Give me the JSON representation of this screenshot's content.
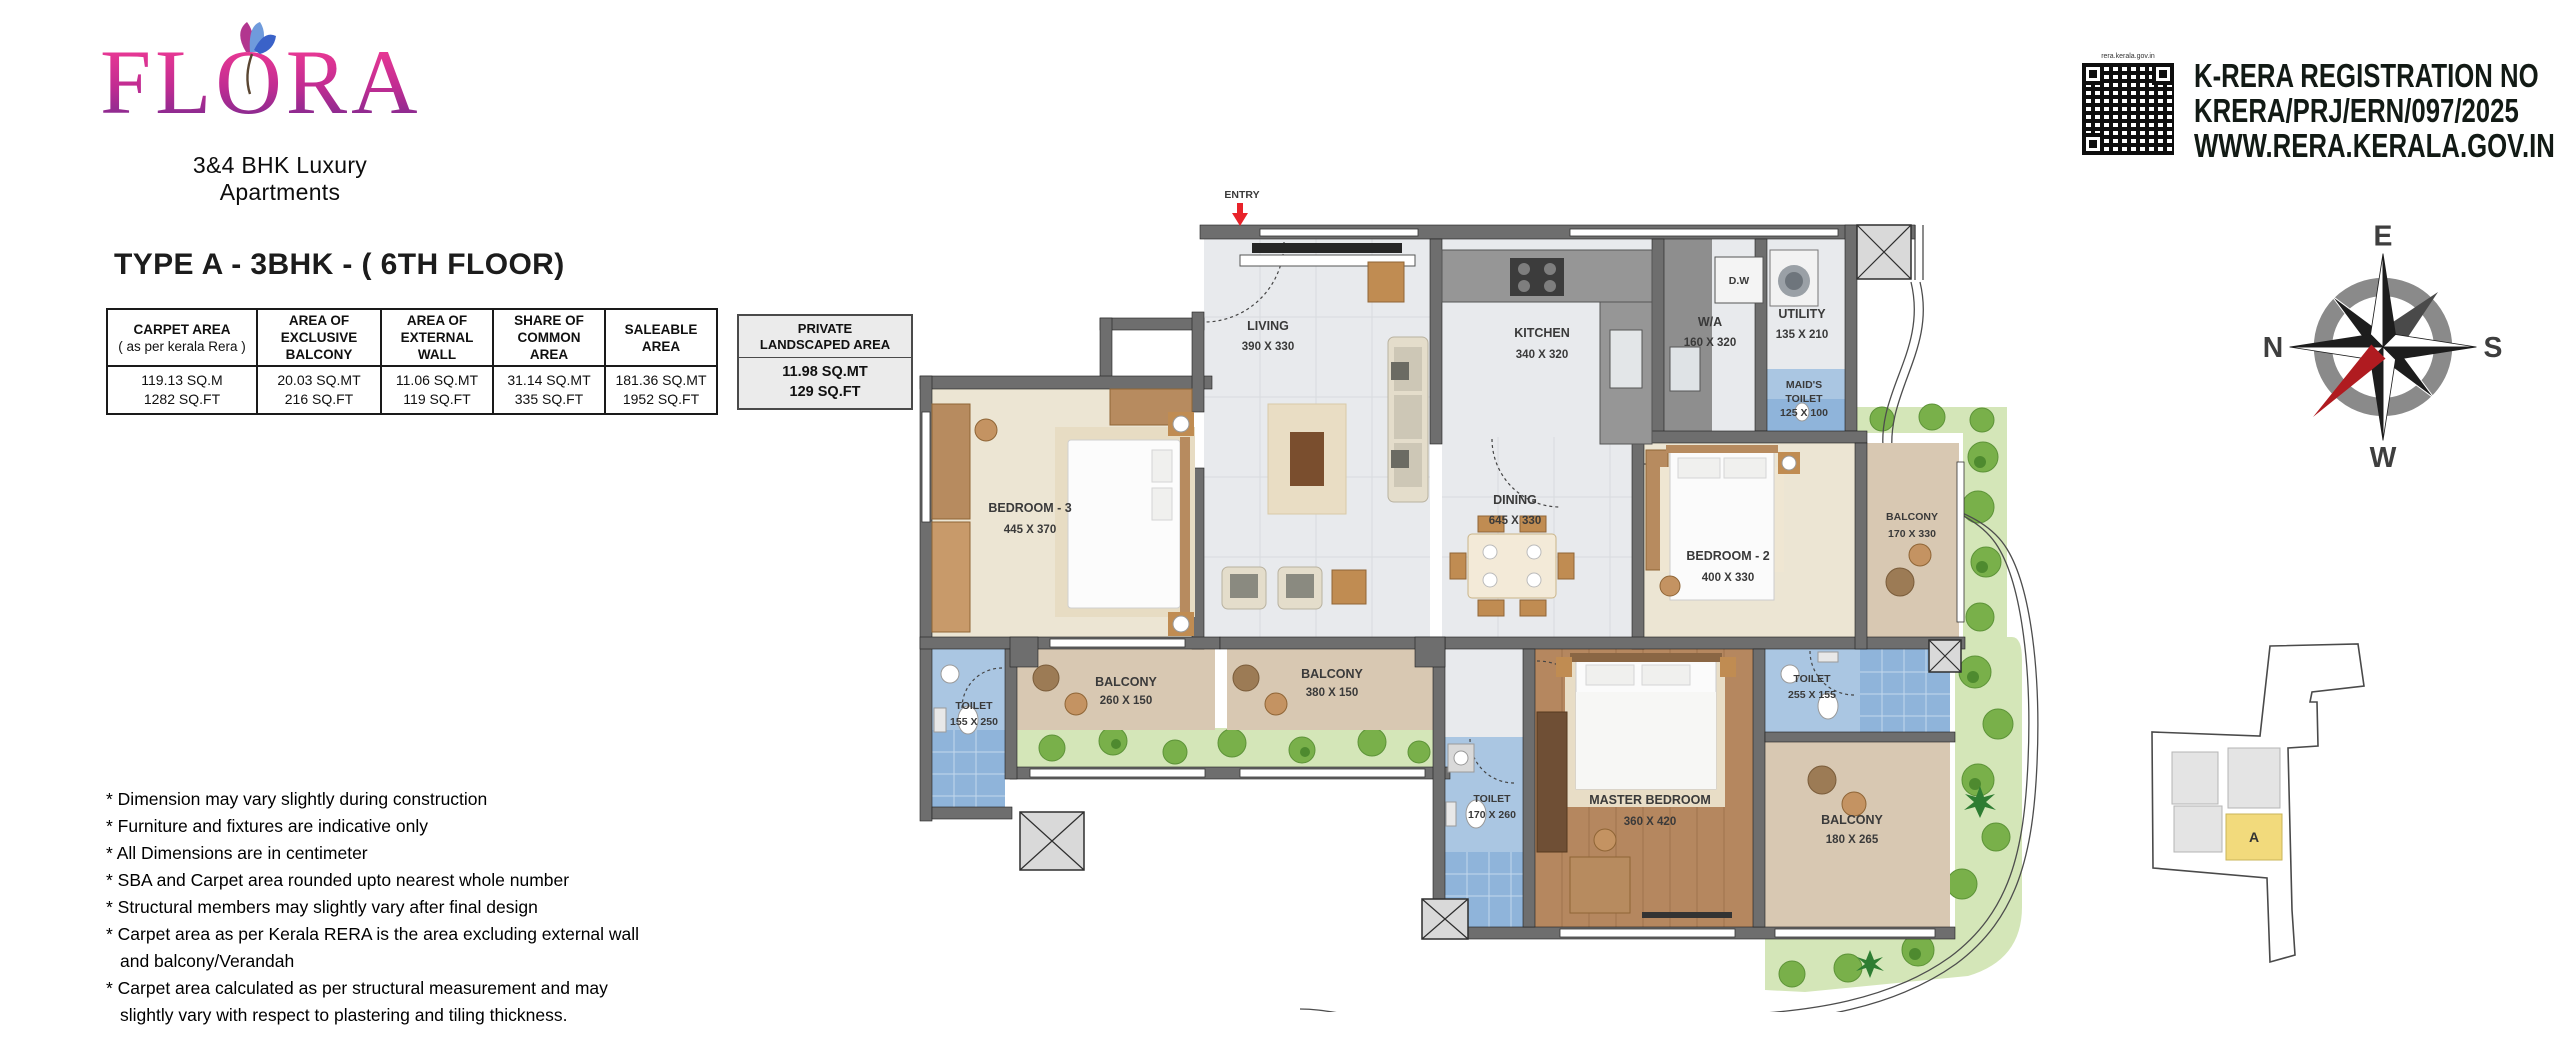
{
  "brand": {
    "name": "FLORA",
    "tagline_line1": "3&4 BHK Luxury",
    "tagline_line2": "Apartments"
  },
  "title": "TYPE A - 3BHK  - ( 6TH FLOOR)",
  "area_table": {
    "columns": [
      {
        "header_line1": "CARPET AREA",
        "header_line2": "( as per kerala Rera )",
        "value_line1": "119.13 SQ.M",
        "value_line2": "1282 SQ.FT"
      },
      {
        "header_line1": "AREA OF",
        "header_line2": "EXCLUSIVE BALCONY",
        "value_line1": "20.03 SQ.MT",
        "value_line2": "216 SQ.FT"
      },
      {
        "header_line1": "AREA OF",
        "header_line2": "EXTERNAL WALL",
        "value_line1": "11.06 SQ.MT",
        "value_line2": "119 SQ.FT"
      },
      {
        "header_line1": "SHARE OF",
        "header_line2": "COMMON AREA",
        "value_line1": "31.14 SQ.MT",
        "value_line2": "335 SQ.FT"
      },
      {
        "header_line1": "SALEABLE AREA",
        "header_line2": "",
        "value_line1": "181.36 SQ.MT",
        "value_line2": "1952 SQ.FT"
      }
    ]
  },
  "private_landscaped": {
    "title_line1": "PRIVATE",
    "title_line2": "LANDSCAPED AREA",
    "value_line1": "11.98  SQ.MT",
    "value_line2": "129 SQ.FT"
  },
  "notes": [
    "* Dimension may vary slightly during construction",
    "* Furniture and fixtures are indicative only",
    "* All Dimensions are in centimeter",
    "* SBA and Carpet area rounded upto nearest whole number",
    "* Structural members may slightly vary after final design",
    "* Carpet area as per Kerala RERA is the area excluding external wall and balcony/Verandah",
    "* Carpet area calculated as per structural measurement and may slightly vary with respect to plastering and tiling thickness."
  ],
  "rera": {
    "line1": "K-RERA REGISTRATION NO",
    "line2": "KRERA/PRJ/ERN/097/2025",
    "line3": "WWW.RERA.KERALA.GOV.IN",
    "qr_caption": "rera.kerala.gov.in"
  },
  "compass": {
    "top": "E",
    "right": "S",
    "bottom": "W",
    "left": "N"
  },
  "key_plan": {
    "unit_label": "A"
  },
  "floor_plan": {
    "entry_label": "ENTRY",
    "rooms": [
      {
        "name": "LIVING",
        "dims": "390 X 330"
      },
      {
        "name": "KITCHEN",
        "dims": "340 X 320"
      },
      {
        "name": "D.W",
        "dims": ""
      },
      {
        "name": "W/A",
        "dims": "160 X 320"
      },
      {
        "name": "UTILITY",
        "dims": "135 X 210"
      },
      {
        "name": "MAID'S",
        "name2": "TOILET",
        "dims": "125 X 100"
      },
      {
        "name": "DINING",
        "dims": "645 X 330"
      },
      {
        "name": "BEDROOM - 3",
        "dims": "445 X 370"
      },
      {
        "name": "BEDROOM - 2",
        "dims": "400 X 330"
      },
      {
        "name": "BALCONY",
        "dims": "170 X 330"
      },
      {
        "name": "TOILET",
        "dims": "155 X 250"
      },
      {
        "name": "BALCONY",
        "dims": "260 X 150"
      },
      {
        "name": "BALCONY",
        "dims": "380 X 150"
      },
      {
        "name": "TOILET",
        "dims": "170 X 260"
      },
      {
        "name": "MASTER BEDROOM",
        "dims": "360 X 420"
      },
      {
        "name": "TOILET",
        "dims": "255 X 155"
      },
      {
        "name": "BALCONY",
        "dims": "180 X 265"
      }
    ]
  },
  "colors": {
    "brand_pink": "#ee3a94",
    "brand_purple": "#7c2a90",
    "entry_red": "#e8232a",
    "keyplan_highlight": "#f2da7c",
    "rera_text": "#121a15"
  }
}
